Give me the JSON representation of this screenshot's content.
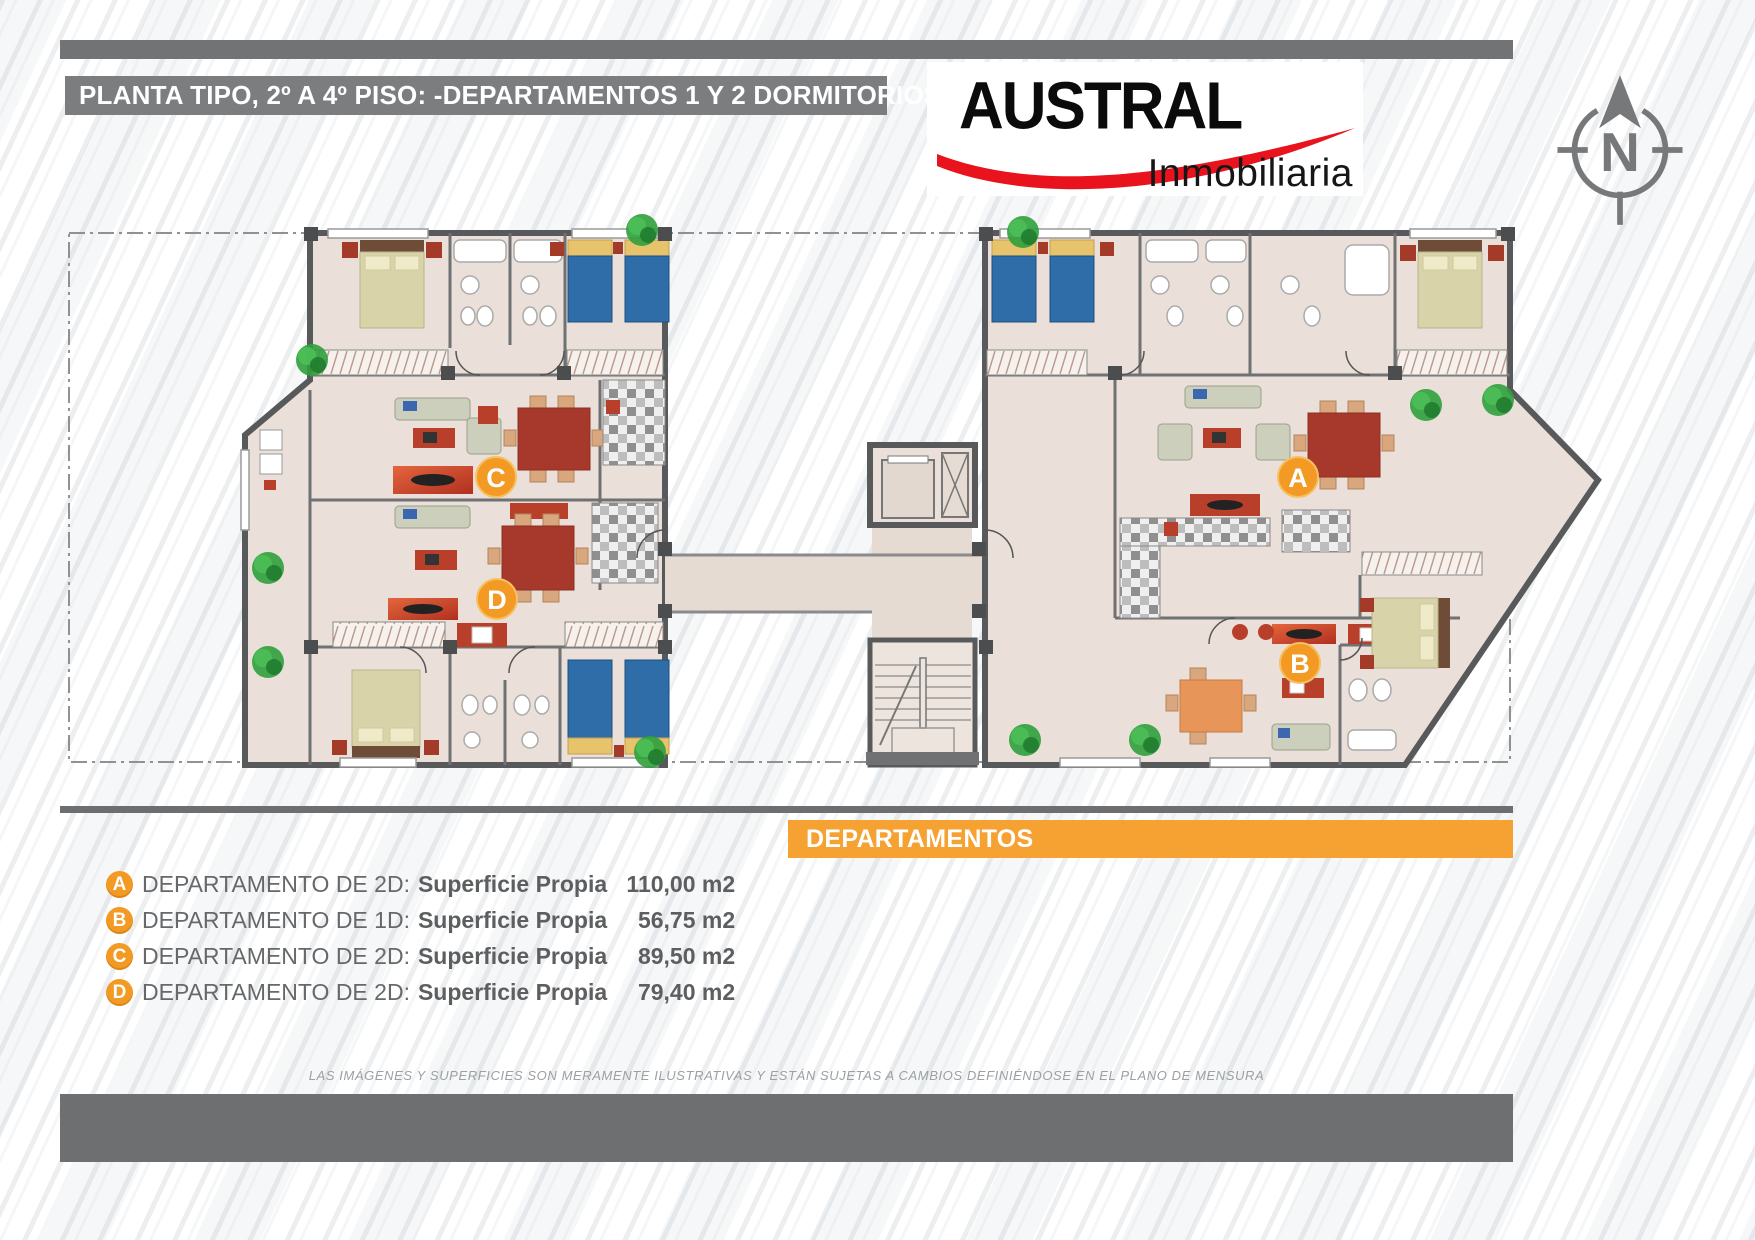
{
  "header": {
    "title": "PLANTA TIPO, 2º A 4º PISO: -DEPARTAMENTOS 1 Y 2 DORMITORIOS",
    "brand": {
      "name": "AUSTRAL",
      "tagline": "Inmobiliaria"
    },
    "compass_label": "N"
  },
  "plan": {
    "badges": {
      "a": "A",
      "b": "B",
      "c": "C",
      "d": "D"
    }
  },
  "legend": {
    "section_title": "DEPARTAMENTOS",
    "items": [
      {
        "badge": "A",
        "label": "DEPARTAMENTO DE 2D:",
        "detail": "Superficie Propia",
        "area": "110,00 m2"
      },
      {
        "badge": "B",
        "label": "DEPARTAMENTO DE 1D:",
        "detail": "Superficie Propia",
        "area": "56,75 m2"
      },
      {
        "badge": "C",
        "label": "DEPARTAMENTO DE 2D:",
        "detail": "Superficie Propia",
        "area": "89,50 m2"
      },
      {
        "badge": "D",
        "label": "DEPARTAMENTO DE 2D:",
        "detail": "Superficie Propia",
        "area": "79,40 m2"
      }
    ]
  },
  "footer": {
    "disclaimer": "LAS IMÁGENES Y SUPERFICIES SON MERAMENTE ILUSTRATIVAS Y ESTÁN SUJETAS A CAMBIOS DEFINIÉNDOSE EN EL PLANO DE MENSURA"
  },
  "colors": {
    "accent_orange": "#F6A233",
    "badge_orange": "#F29A23",
    "brand_red": "#E8131C",
    "bar_gray": "#6F7173",
    "wall_gray": "#58595B",
    "floor_beige": "#EAE0D9"
  }
}
